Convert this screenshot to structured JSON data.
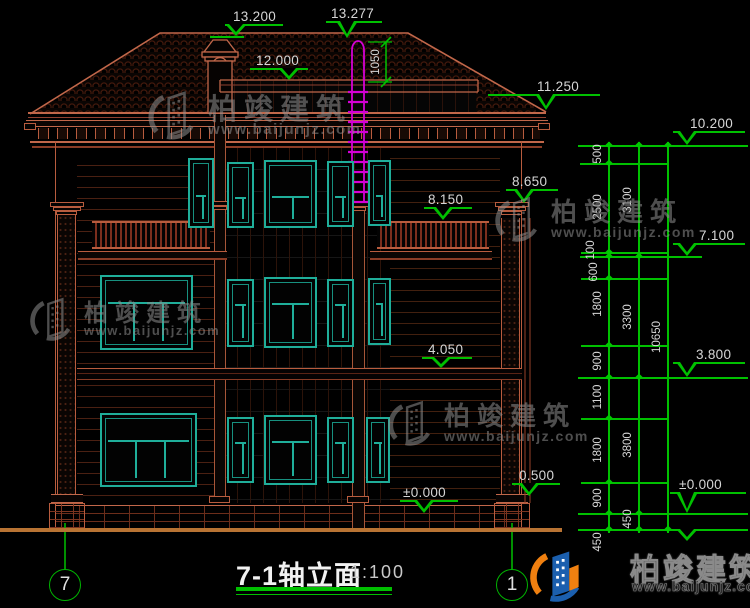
{
  "title_block": {
    "title": "7-1轴立面",
    "scale": "1:100"
  },
  "axes": {
    "left": "7",
    "right": "1"
  },
  "branding": {
    "name": "柏竣建筑",
    "url": "www.baijunjz.com"
  },
  "colors": {
    "dim_green": "#00c000",
    "text": "#d6d6d6",
    "window_teal": "#1fae9a",
    "line_salmon": "#c1674a",
    "pipe_magenta": "#d400d4",
    "ground": "#b87333",
    "logo_blue": "#1b5fae",
    "logo_orange": "#f08010"
  },
  "elevation_markers": [
    {
      "label": "13.200",
      "text": [
        233,
        9
      ],
      "line": [
        225,
        24,
        58
      ],
      "apex": [
        236,
        36
      ]
    },
    {
      "label": "13.277",
      "text": [
        331,
        6
      ],
      "line": [
        326,
        21,
        56
      ],
      "apex": [
        347,
        38
      ]
    },
    {
      "label": "12.000",
      "text": [
        256,
        53
      ],
      "line": [
        250,
        68,
        58
      ],
      "apex": [
        289,
        80
      ]
    },
    {
      "label": "11.250",
      "text": [
        537,
        79
      ],
      "line": [
        488,
        94,
        112
      ],
      "apex": [
        546,
        110
      ]
    },
    {
      "label": "8.650",
      "text": [
        512,
        174
      ],
      "line": [
        506,
        189,
        52
      ],
      "apex": [
        524,
        203
      ]
    },
    {
      "label": "8.150",
      "text": [
        428,
        192
      ],
      "line": [
        424,
        207,
        48
      ],
      "apex": [
        443,
        220
      ]
    },
    {
      "label": "4.050",
      "text": [
        428,
        342
      ],
      "line": [
        422,
        357,
        50
      ],
      "apex": [
        441,
        368
      ]
    },
    {
      "label": "0.500",
      "text": [
        519,
        468
      ],
      "line": [
        512,
        483,
        48
      ],
      "apex": [
        529,
        496
      ]
    },
    {
      "label": "±0.000",
      "text": [
        403,
        485
      ],
      "line": [
        400,
        500,
        58
      ],
      "apex": [
        424,
        513
      ]
    },
    {
      "label": "10.200",
      "text": [
        690,
        116
      ],
      "line": [
        673,
        131,
        72
      ],
      "apex": [
        687,
        145
      ]
    },
    {
      "label": "7.100",
      "text": [
        699,
        228
      ],
      "line": [
        673,
        243,
        72
      ],
      "apex": [
        687,
        256
      ]
    },
    {
      "label": "3.800",
      "text": [
        696,
        347
      ],
      "line": [
        673,
        362,
        72
      ],
      "apex": [
        687,
        377
      ]
    },
    {
      "label": "±0.000",
      "text": [
        679,
        477
      ],
      "line": [
        670,
        492,
        76
      ],
      "apex": [
        687,
        513
      ]
    },
    {
      "label": "",
      "text": [
        0,
        0
      ],
      "line": [
        670,
        529,
        76
      ],
      "apex": [
        687,
        541
      ]
    }
  ],
  "ext_lines": [
    [
      578,
      145,
      170
    ],
    [
      580,
      163,
      88
    ],
    [
      581,
      252,
      87
    ],
    [
      580,
      256,
      122
    ],
    [
      581,
      278,
      87
    ],
    [
      581,
      345,
      87
    ],
    [
      578,
      377,
      170
    ],
    [
      581,
      418,
      87
    ],
    [
      581,
      482,
      87
    ],
    [
      578,
      513,
      170
    ],
    [
      578,
      529,
      170
    ],
    [
      210,
      36,
      34
    ]
  ],
  "chains": [
    {
      "x": 608,
      "y1": 145,
      "y2": 529,
      "ticks": [
        145,
        163,
        252,
        256,
        278,
        345,
        377,
        418,
        482,
        513,
        529
      ],
      "labels": [
        {
          "t": "500",
          "y": 154
        },
        {
          "t": "2500",
          "y": 207
        },
        {
          "t": "100",
          "y": 250,
          "dx": -7
        },
        {
          "t": "600",
          "y": 272,
          "dx": -4
        },
        {
          "t": "1800",
          "y": 304
        },
        {
          "t": "900",
          "y": 361
        },
        {
          "t": "1100",
          "y": 397
        },
        {
          "t": "1800",
          "y": 450
        },
        {
          "t": "900",
          "y": 498
        },
        {
          "t": "450",
          "y": 542
        }
      ]
    },
    {
      "x": 638,
      "y1": 145,
      "y2": 529,
      "ticks": [
        145,
        256,
        377,
        513,
        529
      ],
      "labels": [
        {
          "t": "3100",
          "y": 200
        },
        {
          "t": "3300",
          "y": 317
        },
        {
          "t": "3800",
          "y": 445
        },
        {
          "t": "450",
          "y": 519
        }
      ]
    },
    {
      "x": 667,
      "y1": 145,
      "y2": 529,
      "ticks": [
        145,
        529
      ],
      "labels": [
        {
          "t": "10650",
          "y": 337
        }
      ]
    }
  ],
  "vert_dim": {
    "label": "1050",
    "x": 386,
    "y1": 42,
    "y2": 82,
    "text": [
      376,
      62
    ]
  },
  "windows": [
    {
      "x": 188,
      "y": 158,
      "w": 26,
      "h": 70,
      "t": 0.5,
      "m": 1
    },
    {
      "x": 227,
      "y": 162,
      "w": 27,
      "h": 66,
      "t": 0.5,
      "m": 1
    },
    {
      "x": 264,
      "y": 160,
      "w": 53,
      "h": 68,
      "t": 0.5,
      "m": 1
    },
    {
      "x": 327,
      "y": 161,
      "w": 27,
      "h": 66,
      "t": 0.5,
      "m": 1
    },
    {
      "x": 368,
      "y": 160,
      "w": 23,
      "h": 66,
      "t": 0.5,
      "m": 1
    },
    {
      "x": 100,
      "y": 275,
      "w": 93,
      "h": 75,
      "t": 0.32,
      "m": 2
    },
    {
      "x": 227,
      "y": 279,
      "w": 27,
      "h": 68,
      "t": 0.32,
      "m": 1
    },
    {
      "x": 264,
      "y": 277,
      "w": 53,
      "h": 71,
      "t": 0.32,
      "m": 1
    },
    {
      "x": 327,
      "y": 279,
      "w": 27,
      "h": 68,
      "t": 0.32,
      "m": 1
    },
    {
      "x": 368,
      "y": 278,
      "w": 23,
      "h": 67,
      "t": 0.32,
      "m": 1
    },
    {
      "x": 100,
      "y": 413,
      "w": 97,
      "h": 74,
      "t": 0.32,
      "m": 2
    },
    {
      "x": 227,
      "y": 417,
      "w": 27,
      "h": 66,
      "t": 0.32,
      "m": 1
    },
    {
      "x": 264,
      "y": 415,
      "w": 53,
      "h": 70,
      "t": 0.32,
      "m": 1
    },
    {
      "x": 327,
      "y": 417,
      "w": 27,
      "h": 66,
      "t": 0.32,
      "m": 1
    },
    {
      "x": 366,
      "y": 417,
      "w": 24,
      "h": 66,
      "t": 0.32,
      "m": 1
    }
  ],
  "watermarks": [
    {
      "x": 146,
      "y": 86,
      "g": 56,
      "ts": 29,
      "us": 15
    },
    {
      "x": 28,
      "y": 293,
      "g": 50,
      "ts": 24,
      "us": 13
    },
    {
      "x": 386,
      "y": 396,
      "g": 52,
      "ts": 26,
      "us": 14
    },
    {
      "x": 493,
      "y": 192,
      "g": 52,
      "ts": 26,
      "us": 14
    }
  ]
}
